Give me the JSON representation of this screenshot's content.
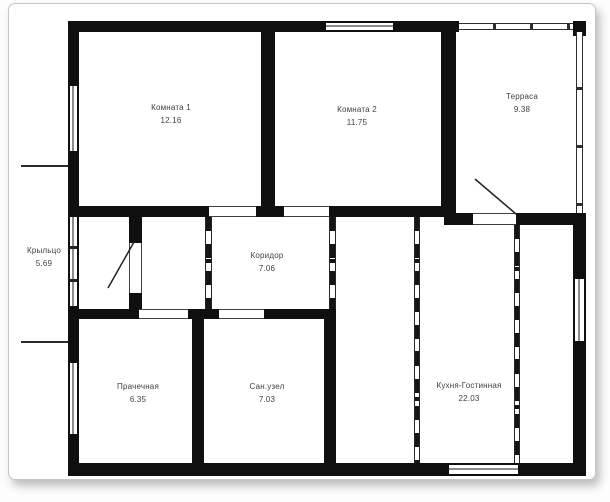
{
  "document": {
    "type": "floor-plan",
    "language": "ru"
  },
  "rooms": [
    {
      "id": "room1",
      "name": "Комната 1",
      "area": "12.16"
    },
    {
      "id": "room2",
      "name": "Комната 2",
      "area": "11.75"
    },
    {
      "id": "terrace",
      "name": "Терраса",
      "area": "9.38"
    },
    {
      "id": "porch",
      "name": "Крыльцо",
      "area": "5.69"
    },
    {
      "id": "corridor",
      "name": "Коридор",
      "area": "7.06"
    },
    {
      "id": "laundry",
      "name": "Прачечная",
      "area": "6.35"
    },
    {
      "id": "bathroom",
      "name": "Сан.узел",
      "area": "7.03"
    },
    {
      "id": "kitchen",
      "name": "Кухня-Гостинная",
      "area": "22.03"
    }
  ],
  "colors": {
    "wall": "#0f0f0f",
    "label": "#3f3f3f",
    "page_border": "#c6c6c6",
    "background": "#ffffff"
  }
}
